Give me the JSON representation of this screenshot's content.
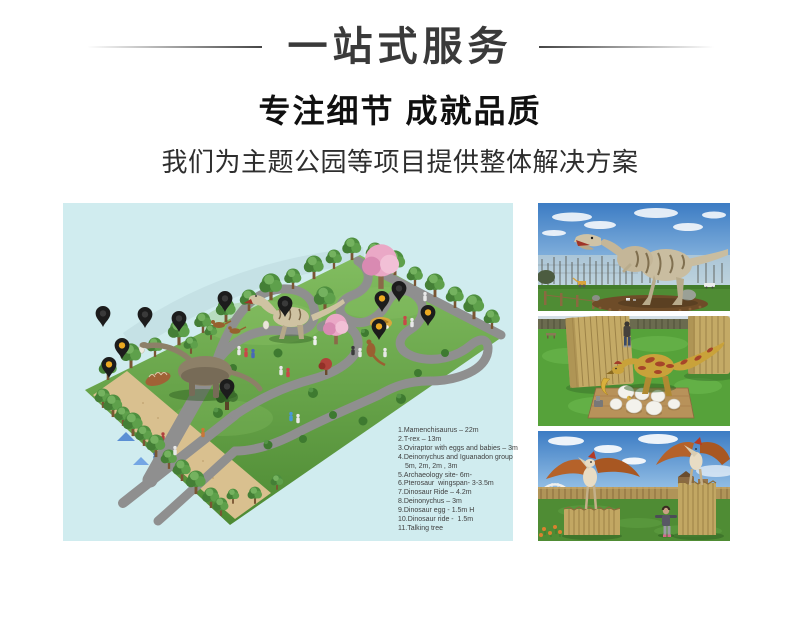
{
  "header": {
    "title": "一站式服务",
    "subtitle": "专注细节 成就品质",
    "description": "我们为主题公园等项目提供整体解决方案"
  },
  "plan": {
    "alt": "Isometric dinosaur theme park master plan with location pins",
    "legend_lines": [
      "1.Mamenchisaurus – 22m",
      "2.T-rex – 13m",
      "3.Oviraptor with eggs and babies – 3m",
      "4.Deinonychus and Iguanadon group",
      "5m, 2m, 2m , 3m",
      "5.Archaeology site- 6m-",
      "6.Pterosaur  wingspan- 3-3.5m",
      "7.Dinosaur Ride – 4.2m",
      "8.Deinonychus – 3m",
      "9.Dinosaur egg - 1.5m H",
      "10.Dinosaur ride -  1.5m",
      "11.Talking tree"
    ]
  },
  "photos": [
    {
      "alt": "Animatronic T-rex standing on mulch bed, blue sky and bare trees behind"
    },
    {
      "alt": "Animatronic Oviraptor guarding white eggs beside wooden post columns"
    },
    {
      "alt": "Two animatronic pterosaurs on wooden plinths with a child between them"
    }
  ],
  "colors": {
    "plan_background": "#d0ecef",
    "pin_black": "#1c1c1c",
    "pin_amber": "#eda921",
    "headline_text": "#3a3a3a",
    "body_text": "#2e2e2e",
    "legend_text": "#3f3f3f",
    "grass_green": "#5a9a3e",
    "path_gray": "#8f8f8f",
    "sand_tan": "#d9c08f",
    "sky_blue": "#3c7cc4"
  }
}
